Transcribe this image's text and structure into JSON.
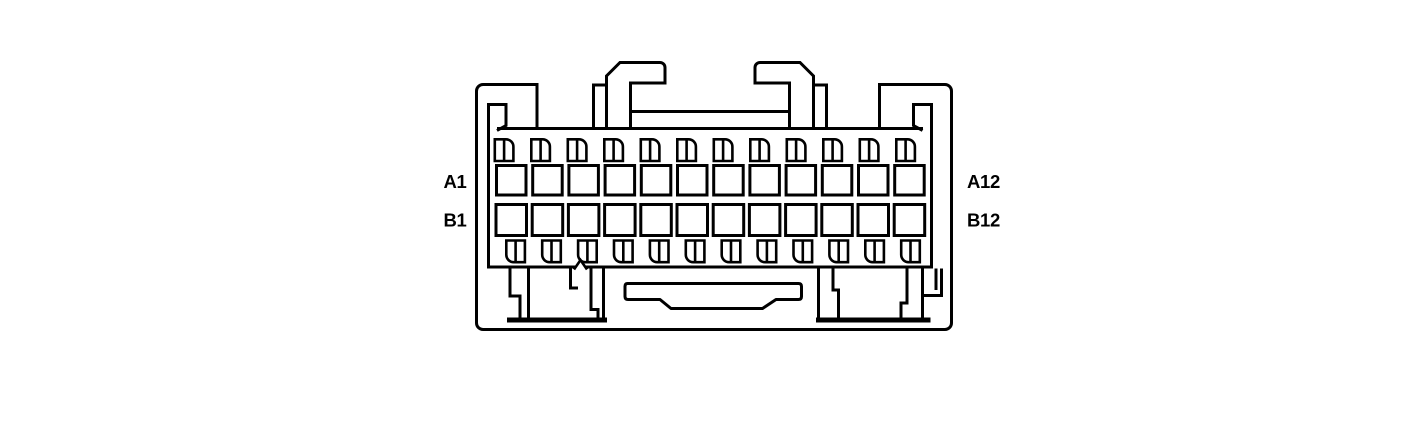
{
  "diagram": {
    "kind": "connector-face-pinout",
    "background_color": "#ffffff",
    "line_color": "#000000",
    "label_color": "#000000",
    "labels": {
      "row_a_first": "A1",
      "row_a_last": "A12",
      "row_b_first": "B1",
      "row_b_last": "B12"
    },
    "pin_rows": [
      {
        "row": "A",
        "cavity_count": 12
      },
      {
        "row": "B",
        "cavity_count": 12
      }
    ],
    "key_slot_rows": [
      {
        "position": "top",
        "count": 12
      },
      {
        "position": "bottom",
        "count": 12
      }
    ],
    "total_cavities": 24
  }
}
